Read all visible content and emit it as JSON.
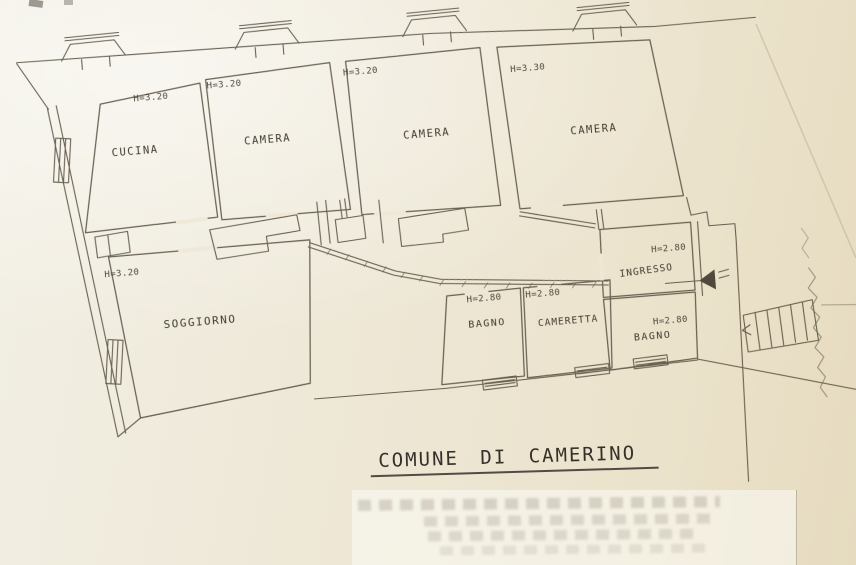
{
  "document": {
    "type": "floor-plan",
    "municipality_title": "COMUNE DI CAMERINO"
  },
  "plan": {
    "rooms": [
      {
        "id": "cucina",
        "label": "CUCINA",
        "height": "H=3.20"
      },
      {
        "id": "camera-1",
        "label": "CAMERA",
        "height": "H=3.20"
      },
      {
        "id": "camera-2",
        "label": "CAMERA",
        "height": "H=3.20"
      },
      {
        "id": "camera-3",
        "label": "CAMERA",
        "height": "H=3.30"
      },
      {
        "id": "soggiorno",
        "label": "SOGGIORNO",
        "height": "H=3.20"
      },
      {
        "id": "bagno-1",
        "label": "BAGNO",
        "height": "H=2.80"
      },
      {
        "id": "cameretta",
        "label": "CAMERETTA",
        "height": "H=2.80"
      },
      {
        "id": "ingresso",
        "label": "INGRESSO",
        "height": "H=2.80"
      },
      {
        "id": "bagno-2",
        "label": "BAGNO",
        "height": "H=2.80"
      }
    ],
    "colors": {
      "paper": "#efe8d6",
      "ink": "#564e3e"
    }
  }
}
